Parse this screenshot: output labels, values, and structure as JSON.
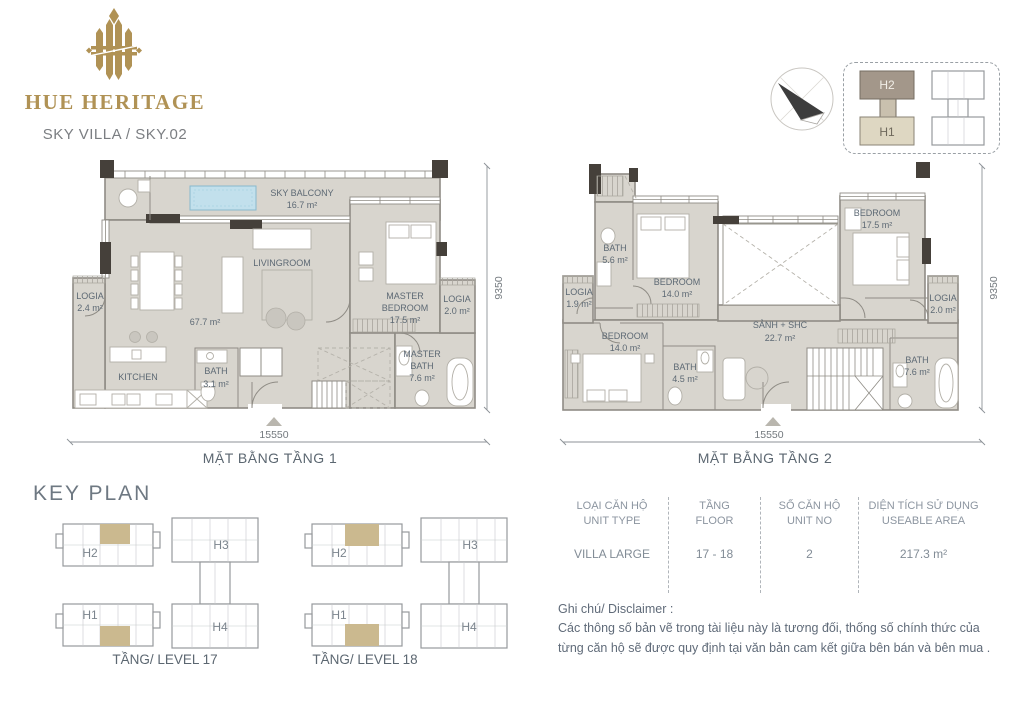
{
  "brand": {
    "wordmark": "HUE HERITAGE",
    "subtitle": "SKY VILLA / SKY.02"
  },
  "mini_key_plan": {
    "h2": "H2",
    "h1": "H1"
  },
  "plan1": {
    "caption": "MẶT BẰNG TẦNG 1",
    "dim_bottom": "15550",
    "dim_right": "9350",
    "rooms": {
      "sky_balcony": {
        "name": "SKY BALCONY",
        "area": "16.7 m²"
      },
      "livingroom": {
        "name": "LIVINGROOM"
      },
      "main": {
        "area": "67.7 m²"
      },
      "logia_left": {
        "name": "LOGIA",
        "area": "2.4 m²"
      },
      "kitchen": {
        "name": "KITCHEN"
      },
      "bath": {
        "name": "BATH",
        "area": "3.1 m²"
      },
      "master_bedroom": {
        "line1": "MASTER",
        "line2": "BEDROOM",
        "area": "17.5 m²"
      },
      "logia_right": {
        "name": "LOGIA",
        "area": "2.0 m²"
      },
      "master_bath": {
        "line1": "MASTER",
        "line2": "BATH",
        "area": "7.6 m²"
      }
    }
  },
  "plan2": {
    "caption": "MẶT BẰNG TẦNG 2",
    "dim_bottom": "15550",
    "dim_right": "9350",
    "rooms": {
      "bath_top": {
        "name": "BATH",
        "area": "5.6 m²"
      },
      "bedroom_top": {
        "name": "BEDROOM",
        "area": "14.0 m²"
      },
      "bedroom_right": {
        "name": "BEDROOM",
        "area": "17.5 m²"
      },
      "logia_left": {
        "name": "LOGIA",
        "area": "1.9 m²"
      },
      "bedroom_bottom": {
        "name": "BEDROOM",
        "area": "14.0 m²"
      },
      "bath_mid": {
        "name": "BATH",
        "area": "4.5 m²"
      },
      "hall": {
        "name": "SẢNH + SHC",
        "area": "22.7 m²"
      },
      "bath_right": {
        "name": "BATH",
        "area": "7.6 m²"
      },
      "logia_right": {
        "name": "LOGIA",
        "area": "2.0 m²"
      }
    }
  },
  "key_plan": {
    "title": "KEY PLAN",
    "levels": [
      {
        "caption": "TẦNG/ LEVEL 17",
        "b0": "H2",
        "b1": "H3",
        "b2": "H1",
        "b3": "H4"
      },
      {
        "caption": "TẦNG/ LEVEL 18",
        "b0": "H2",
        "b1": "H3",
        "b2": "H1",
        "b3": "H4"
      }
    ]
  },
  "info_table": {
    "columns": [
      {
        "vi": "LOẠI CĂN HỘ",
        "en": "UNIT TYPE",
        "value": "VILLA LARGE"
      },
      {
        "vi": "TẦNG",
        "en": "FLOOR",
        "value": "17 - 18"
      },
      {
        "vi": "SỐ CĂN HỘ",
        "en": "UNIT NO",
        "value": "2"
      },
      {
        "vi": "DIỆN TÍCH SỬ DỤNG",
        "en": "USEABLE AREA",
        "value": "217.3 m²"
      }
    ]
  },
  "disclaimer": {
    "title": "Ghi chú/ Disclaimer :",
    "line1": "Các thông số bản vẽ trong tài liệu này là tương đối, thống số chính thức của",
    "line2": "từng căn hộ sẽ được quy định tại văn bản cam kết giữa bên bán và bên mua ."
  },
  "colors": {
    "brand_gold": "#b09255",
    "floor": "#d8d5ce",
    "highlight_tan": "#cbb98f",
    "pool_blue": "#c2e0ec"
  }
}
